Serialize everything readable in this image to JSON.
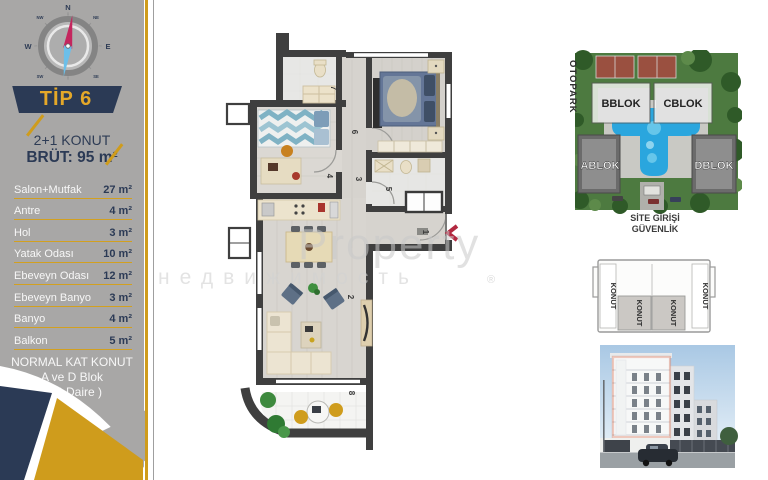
{
  "sidebar": {
    "tip": "TİP 6",
    "subtitle": "2+1 KONUT",
    "brut": "BRÜT: 95 m²",
    "rooms": [
      {
        "name": "Salon+Mutfak",
        "area": "27 m²"
      },
      {
        "name": "Antre",
        "area": "4 m²"
      },
      {
        "name": "Hol",
        "area": "3 m²"
      },
      {
        "name": "Yatak Odası",
        "area": "10 m²"
      },
      {
        "name": "Ebeveyn Odası",
        "area": "12 m²"
      },
      {
        "name": "Ebeveyn Banyo",
        "area": "3 m²"
      },
      {
        "name": "Banyo",
        "area": "4 m²"
      },
      {
        "name": "Balkon",
        "area": "5 m²"
      }
    ],
    "footer": [
      "NORMAL KAT KONUT",
      "A ve D Blok",
      "( 20 Daire )"
    ]
  },
  "compass": {
    "n": "N",
    "e": "E",
    "s": "S",
    "w": "W",
    "ne": "NE",
    "nw": "NW",
    "se": "SE",
    "sw": "SW"
  },
  "plan": {
    "numbers": [
      "1",
      "2",
      "3",
      "4",
      "5",
      "6",
      "7",
      "8"
    ]
  },
  "watermark": {
    "line1": "Property",
    "line2": "недвижимость",
    "reg": "®"
  },
  "site_plan": {
    "otopark": "OTOPARK",
    "blocks": {
      "a": "ABLOK",
      "b": "BBLOK",
      "c": "CBLOK",
      "d": "DBLOK"
    },
    "caption1": "SİTE GİRİŞİ",
    "caption2": "GÜVENLİK"
  },
  "key_plan": {
    "unit": "KONUT"
  },
  "colors": {
    "navy": "#2b3a55",
    "gold": "#cf9c1c",
    "sidebar_gray": "#a8a7a6",
    "entry_marker_red": "#b22840",
    "highlight_orange": "#e2633c",
    "pool_blue": "#2aa6de"
  }
}
